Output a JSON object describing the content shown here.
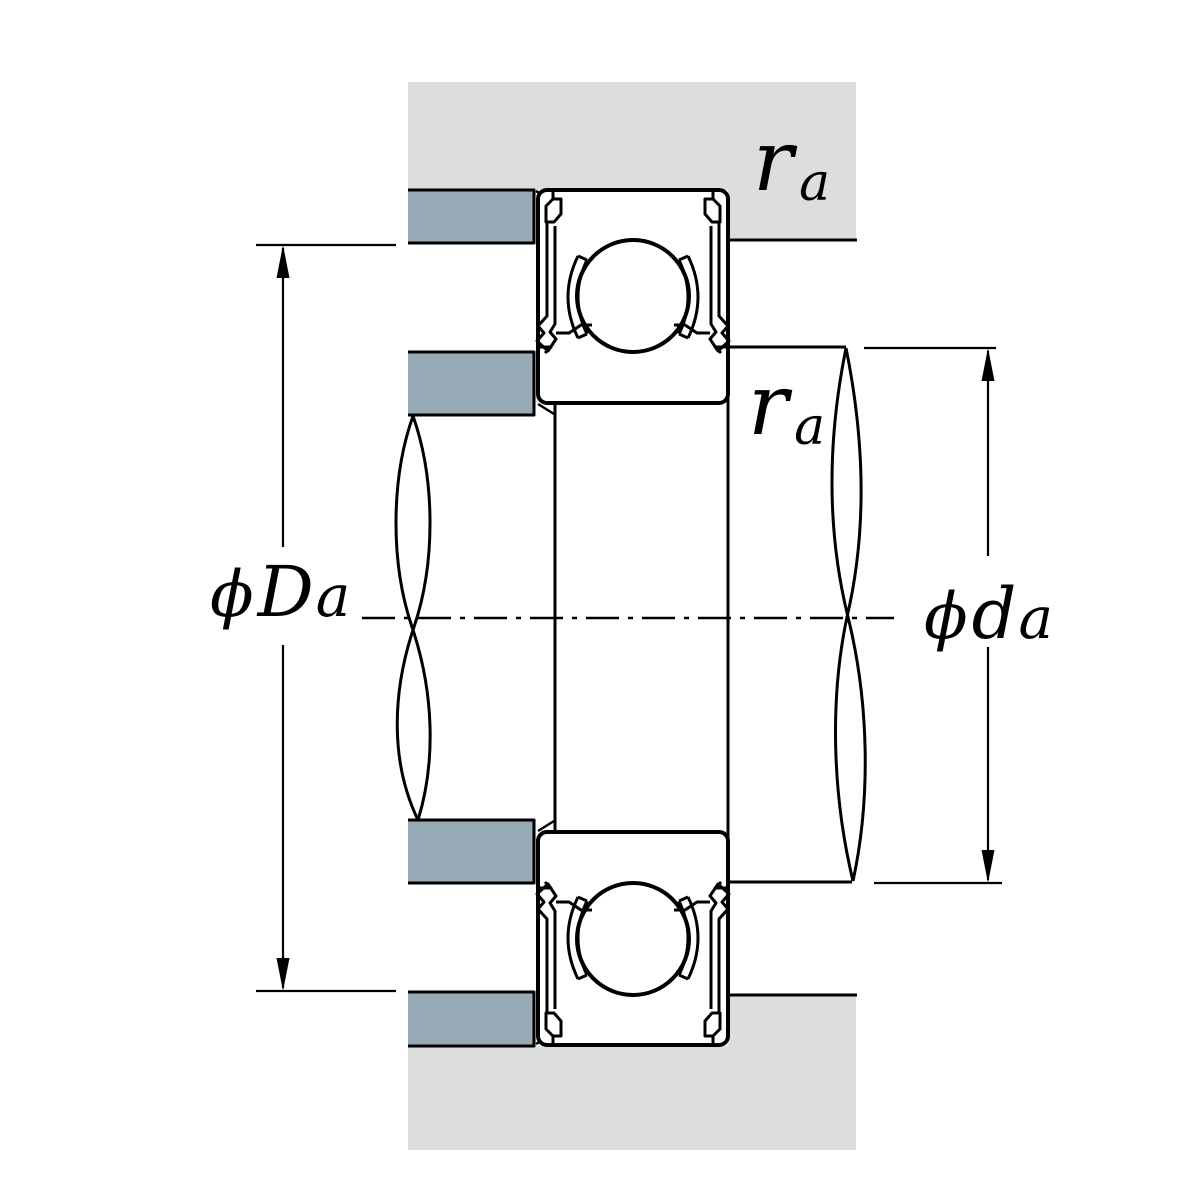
{
  "diagram": {
    "type": "bearing-mounting-cross-section",
    "labels": {
      "housing_abutment_diameter": {
        "phi": "ϕ",
        "letter": "D",
        "sub": "a"
      },
      "shaft_abutment_diameter": {
        "phi": "ϕ",
        "letter": "d",
        "sub": "a"
      },
      "housing_fillet_radius": {
        "letter": "r",
        "sub": "a"
      },
      "shaft_fillet_radius": {
        "letter": "r",
        "sub": "a"
      }
    },
    "colors": {
      "housing_fill": "#dcdedd",
      "shoulder_fill": "#96a9b4",
      "line": "#000000",
      "background": "#ffffff"
    }
  }
}
